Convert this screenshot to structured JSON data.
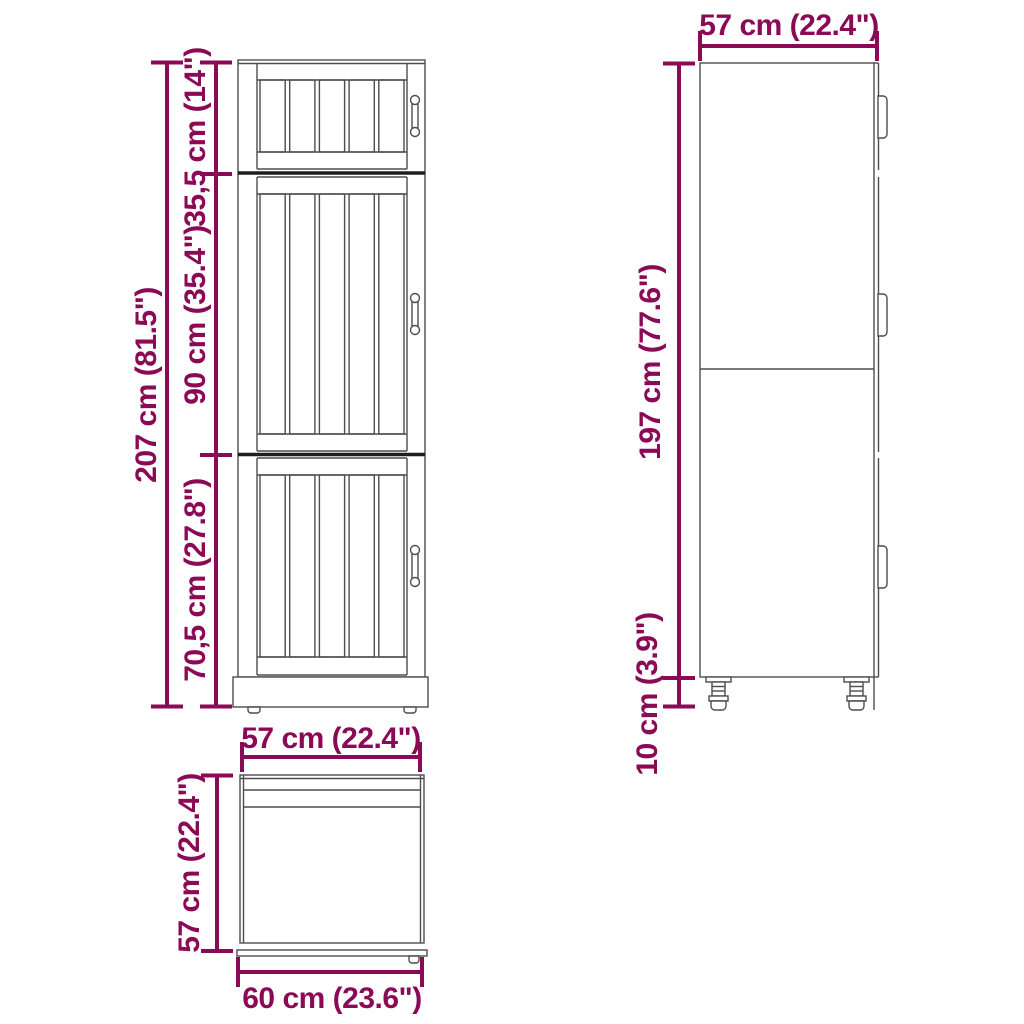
{
  "diagram": {
    "title": "kitchen tall cabinet dimension drawing",
    "front_view": {
      "total_height_label": "207 cm (81.5\")",
      "top_section_label": "35,5 cm (14\")",
      "middle_section_label": "90 cm (35.4\")",
      "bottom_section_label": "70,5 cm (27.8\")"
    },
    "side_view": {
      "width_label": "57 cm (22.4\")",
      "body_height_label": "197 cm (77.6\")",
      "leg_height_label": "10 cm (3.9\")"
    },
    "top_view": {
      "width_label": "57 cm (22.4\")",
      "depth_label": "57 cm (22.4\")",
      "total_depth_label": "60 cm (23.6\")"
    },
    "colors": {
      "dimension": "#8b0a55",
      "outline": "#4d4d4d",
      "divider": "#1e1e1e",
      "background": "#ffffff"
    }
  }
}
